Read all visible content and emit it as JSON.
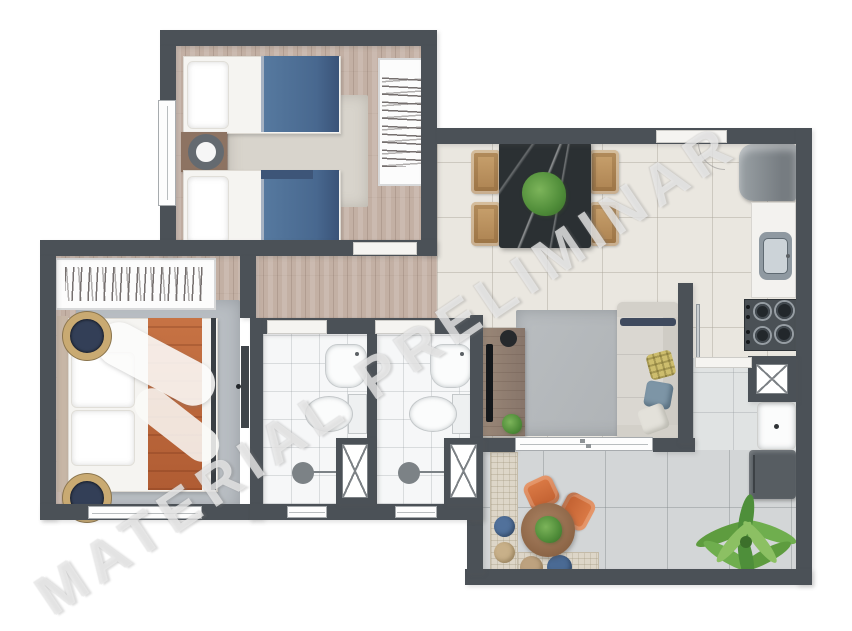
{
  "watermark": {
    "text": "MATERIAL PRELIMINAR"
  },
  "palette": {
    "wall": "#4b5157",
    "wood_floor": "#c3b0a4",
    "tile_floor": "#eae7e0",
    "terrace_floor": "#d3d6d7",
    "service_floor": "#e0e3e3",
    "bathroom_floor": "#f6f7f8",
    "bed_blue": "#4e6f9a",
    "bed_orange": "#c0693f",
    "chair_orange": "#cf6b3a",
    "dining_chair_wood": "#b98e5e",
    "dining_table_marble": "#2b3033",
    "sofa_gray": "#dad7d1",
    "plant_green": "#4e8b38",
    "appliance_gray": "#82888c",
    "gold_lamp": "#c9aa72"
  },
  "rooms": [
    {
      "id": "bedroom-2",
      "furniture": [
        "single-bed",
        "single-bed",
        "nightstand-lamp",
        "wardrobe",
        "rug",
        "window"
      ]
    },
    {
      "id": "master-bedroom",
      "furniture": [
        "double-bed",
        "wardrobe",
        "side-lamp",
        "side-lamp",
        "rug",
        "window",
        "door"
      ]
    },
    {
      "id": "bathroom-1",
      "furniture": [
        "sink",
        "toilet",
        "shower-drain",
        "shaft",
        "window",
        "door-threshold"
      ]
    },
    {
      "id": "bathroom-2",
      "furniture": [
        "sink",
        "toilet",
        "shower-drain",
        "shaft",
        "window",
        "door-threshold"
      ]
    },
    {
      "id": "dining-area",
      "furniture": [
        "marble-table",
        "chair",
        "chair",
        "chair",
        "chair",
        "plant",
        "entry-door"
      ]
    },
    {
      "id": "kitchen",
      "furniture": [
        "refrigerator",
        "counter",
        "sink",
        "cooktop"
      ]
    },
    {
      "id": "living-room",
      "furniture": [
        "sofa",
        "pillows",
        "tv-console",
        "tv",
        "rug",
        "sliding-door"
      ]
    },
    {
      "id": "service-area",
      "furniture": [
        "shaft",
        "laundry-tank",
        "washer",
        "glass-door"
      ]
    },
    {
      "id": "balcony",
      "furniture": [
        "round-table",
        "armchair",
        "armchair",
        "bench",
        "poufs",
        "palm-plant"
      ]
    }
  ]
}
